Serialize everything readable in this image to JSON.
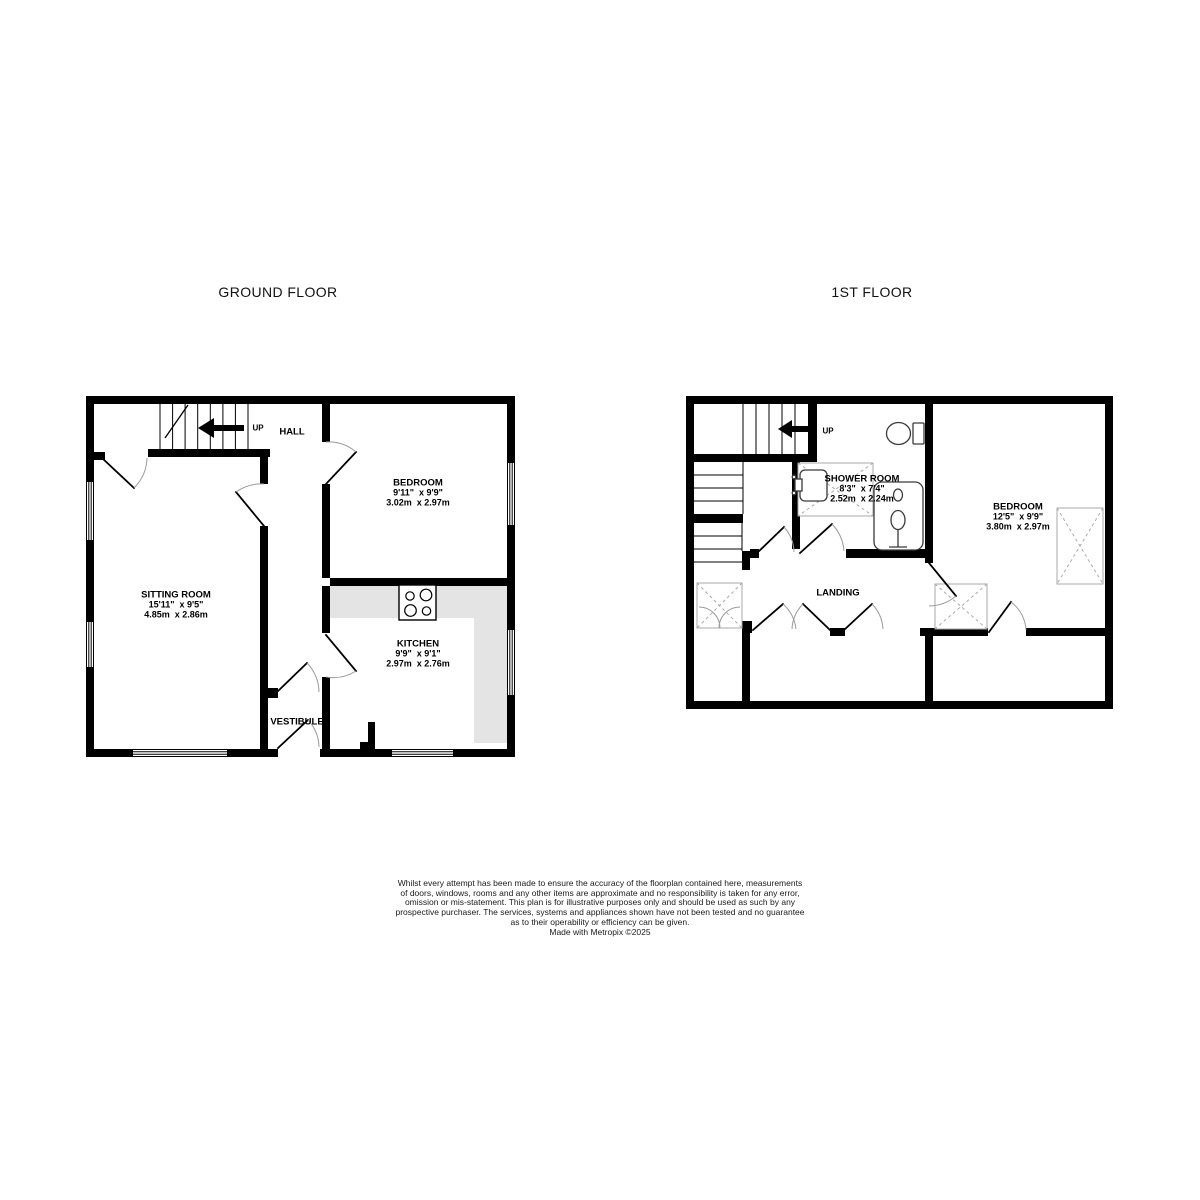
{
  "page": {
    "background": "#ffffff",
    "wall_color": "#000000",
    "counter_color": "#e4e4e4"
  },
  "ground_floor": {
    "title": "GROUND FLOOR",
    "labels": {
      "up": "UP",
      "hall": "HALL",
      "vestibule": "VESTIBULE"
    },
    "rooms": {
      "sitting_room": {
        "name": "SITTING ROOM",
        "imperial": "15'11\"  x 9'5\"",
        "metric": "4.85m  x 2.86m"
      },
      "bedroom": {
        "name": "BEDROOM",
        "imperial": "9'11\"  x 9'9\"",
        "metric": "3.02m  x 2.97m"
      },
      "kitchen": {
        "name": "KITCHEN",
        "imperial": "9'9\"  x 9'1\"",
        "metric": "2.97m  x 2.76m"
      }
    }
  },
  "first_floor": {
    "title": "1ST FLOOR",
    "labels": {
      "up": "UP",
      "landing": "LANDING"
    },
    "rooms": {
      "shower_room": {
        "name": "SHOWER ROOM",
        "imperial": "8'3\"  x 7'4\"",
        "metric": "2.52m  x 2.24m"
      },
      "bedroom": {
        "name": "BEDROOM",
        "imperial": "12'5\"  x 9'9\"",
        "metric": "3.80m  x 2.97m"
      }
    }
  },
  "disclaimer": {
    "lines": [
      "Whilst every attempt has been made to ensure the accuracy of the floorplan contained here, measurements",
      "of doors, windows, rooms and any other items are approximate and no responsibility is taken for any error,",
      "omission or mis-statement. This plan is for illustrative purposes only and should be used as such by any",
      "prospective purchaser. The services, systems and appliances shown have not been tested and no guarantee",
      "as to their operability or efficiency can be given.",
      "Made with Metropix ©2025"
    ]
  }
}
